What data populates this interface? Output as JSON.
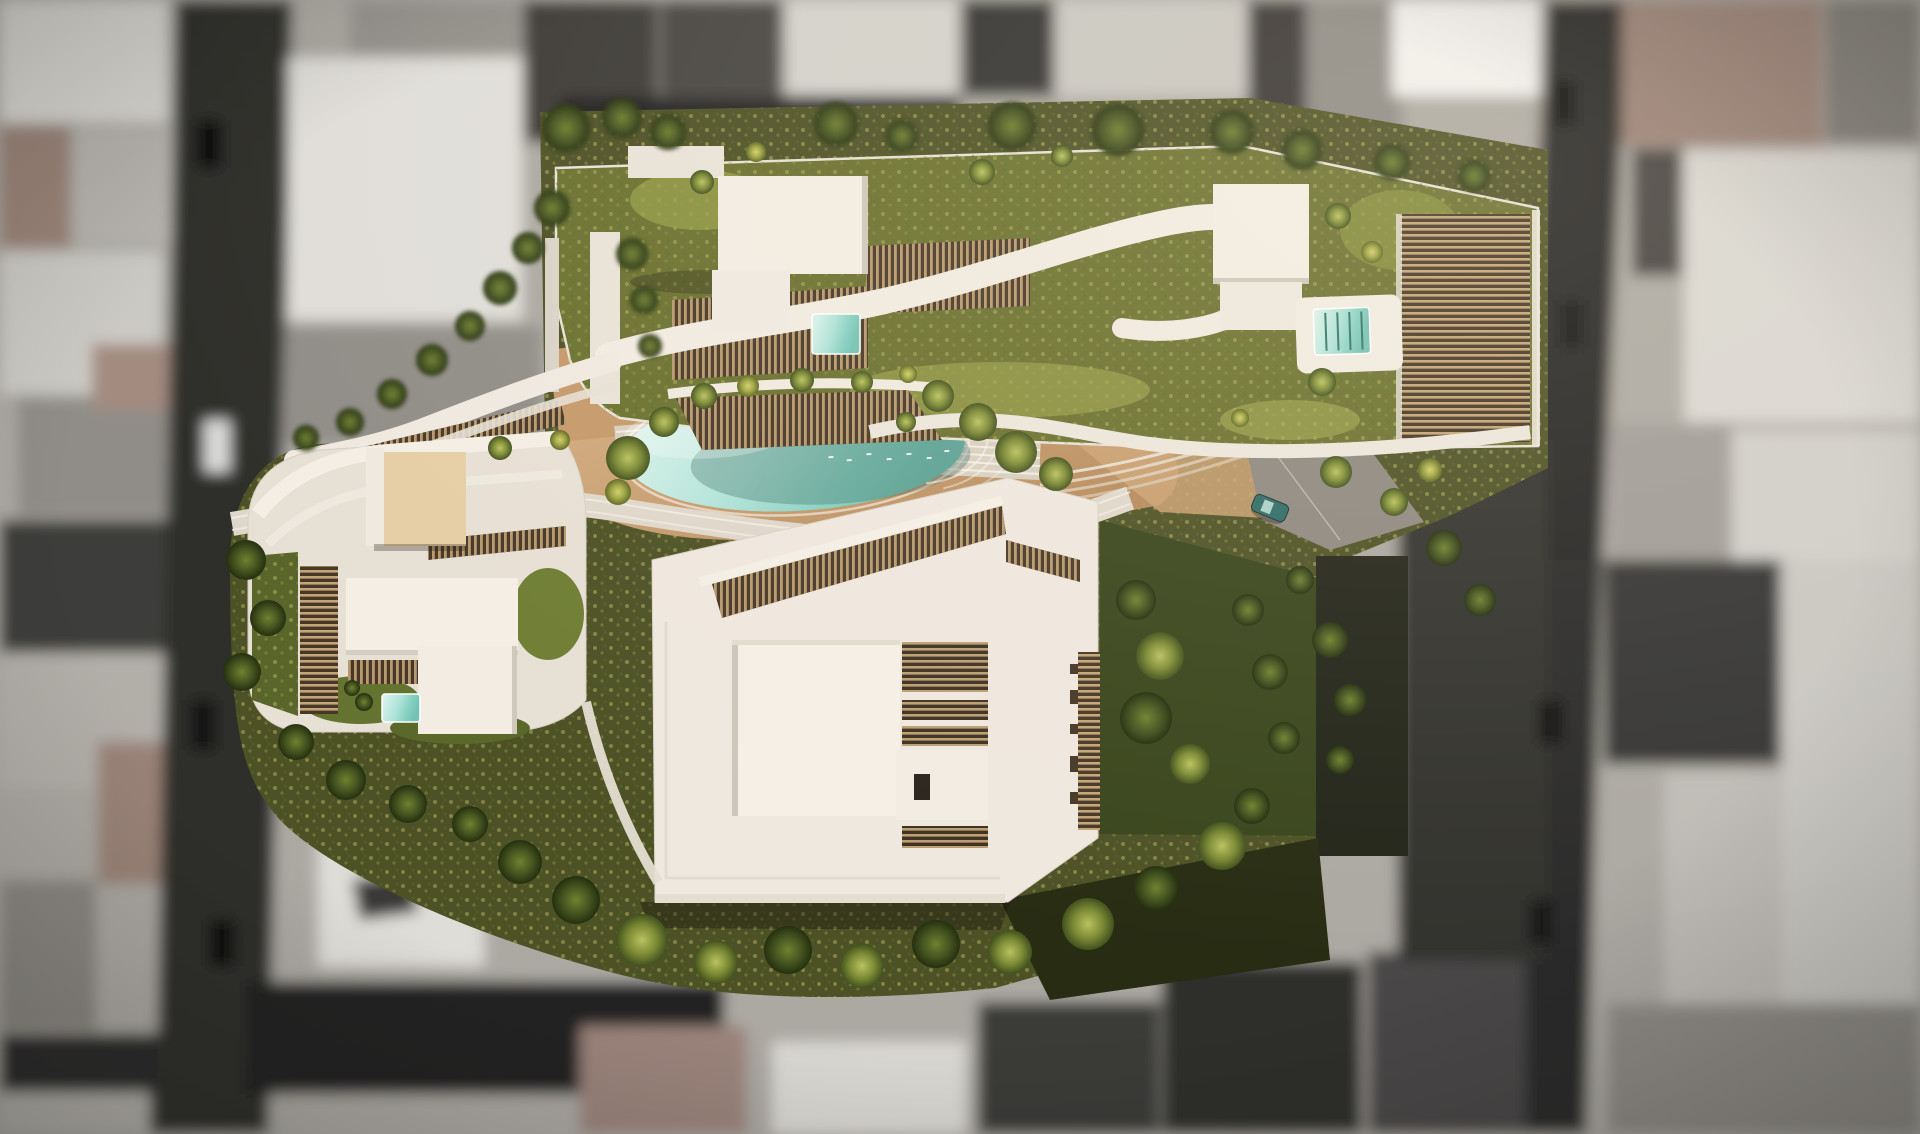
{
  "scene": {
    "type": "architectural-aerial-render",
    "description": "Top-down aerial rendering of a residential development: three sculptural white buildings with curved wavy roof slabs, wooden roof louvers and planted roof gardens around a central courtyard with an organic turquoise pool; surrounding city blocks are desaturated gray and defocused.",
    "elements": {
      "north_building": "curved S-shaped building with roof garden, wooden louver pergolas, two rooftop pools and white core boxes",
      "west_building": "fan-shaped building with curved white roof bands, wooden louver combs and small rooftop plunge pool",
      "south_building": "large rectangular building with white flat roof, slanted louver skylight band and roof hatch box",
      "existing_beige_house": "small beige flat-roofed house kept at north-west of courtyard",
      "central_pool": "organic lagoon-style turquoise pool with stepped end and sun glints",
      "courtyard": "sand-colored paths, curved white ramps and stairs, dense green trees",
      "driveway": "gray drive at east side with one teal car",
      "surroundings": "grayscale blurred city fabric with streets, parked cars, white and mauve roofs"
    }
  },
  "palette": {
    "bg_gray": "#aca9a3",
    "street_asphalt": "#2e2e2c",
    "roof_white": "#d8d6d1",
    "roof_gray": "#908d88",
    "roof_dark": "#3c3b39",
    "roof_mauve": "#9a8378",
    "site_green": "#4d5126",
    "roof_garden_green": "#6a7130",
    "veg_light": "#9aa24b",
    "building_white": "#f1ebe2",
    "building_white_dim": "#ded7cb",
    "wood_dark": "#483727",
    "wood_slat": "#c2a476",
    "sand": "#c59a6b",
    "pool_light": "#dff5ef",
    "pool_deep": "#74c2b4",
    "beige_box": "#e6cea6",
    "car_teal": "#2e6b66"
  }
}
